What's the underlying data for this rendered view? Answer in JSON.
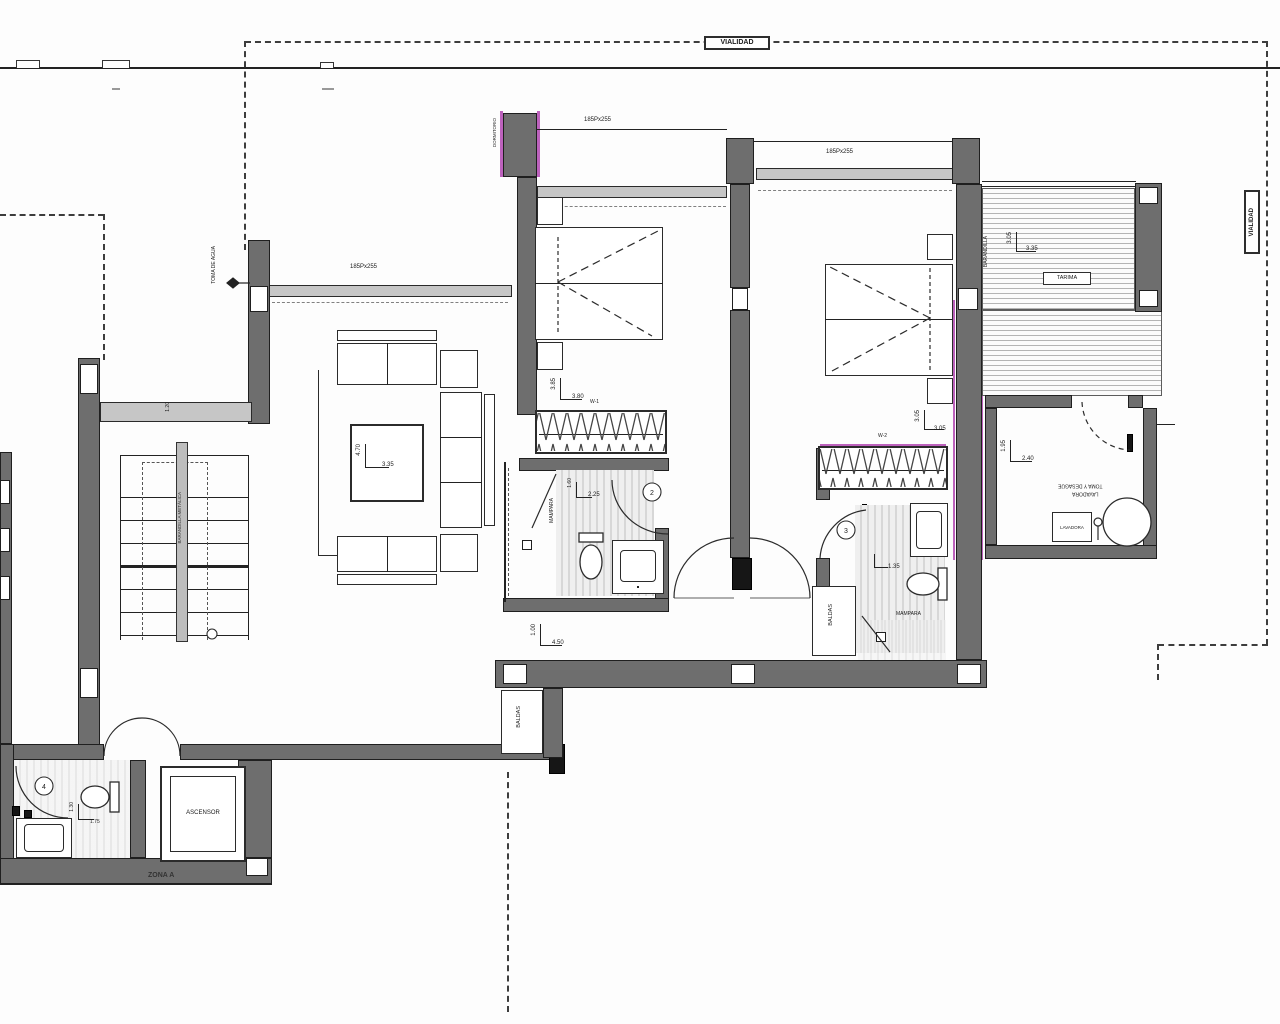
{
  "meta": {
    "drawing_type": "floor plan",
    "colors": {
      "wall": "#6e6e6e",
      "line": "#1f1f1f",
      "accent_magenta": "#bd62bd",
      "hatch": "#b4b4b4"
    }
  },
  "labels": {
    "vialidad_top": "VIALIDAD",
    "vialidad_right": "VIALIDAD",
    "zona": "ZONA A",
    "ascensor": "ASCENSOR",
    "baldas_hall": "BALDAS",
    "baldas_bath2": "BALDAS",
    "mampara_bath1": "MAMPARA",
    "mampara_bath2": "MAMPARA",
    "barandilla_stairs": "BARANDILLA METÁLICA",
    "barandilla_terraza": "BARANDILLA",
    "tarima": "TARIMA",
    "dormitorio_tag": "DORMITORIO",
    "toma_agua": "TOMA DE AGUA",
    "lavadora": "LAVADORA",
    "descalcificador": "DESCALCIFICADOR",
    "toma_desague_1": "TOMA Y DESAGÜE",
    "toma_desague_2": "LAVADORA"
  },
  "windows": {
    "salon": "185Px255",
    "dorm1": "185Px255",
    "dorm2": "185Px255"
  },
  "dims": {
    "salon_v": "4.70",
    "salon_h": "3.35",
    "dorm1_v": "3.85",
    "dorm1_h": "3.80",
    "dorm1_tag": "W-1",
    "dorm2_v": "3.05",
    "dorm2_h": "3.05",
    "dorm2_tag": "W-2",
    "bath1_v": "1.60",
    "bath1_h": "2.25",
    "bath2_h": "1.35",
    "aseo_v": "1.30",
    "aseo_h": "1.75",
    "hall_v": "1.00",
    "hall_h": "4.50",
    "lavadero_v": "1.95",
    "lavadero_h": "2.40",
    "terraza_v": "3.05",
    "terraza_h": "3.35",
    "paso": "1.20"
  },
  "door_numbers": {
    "bath1": "2",
    "bath2": "3",
    "aseo": "4"
  }
}
